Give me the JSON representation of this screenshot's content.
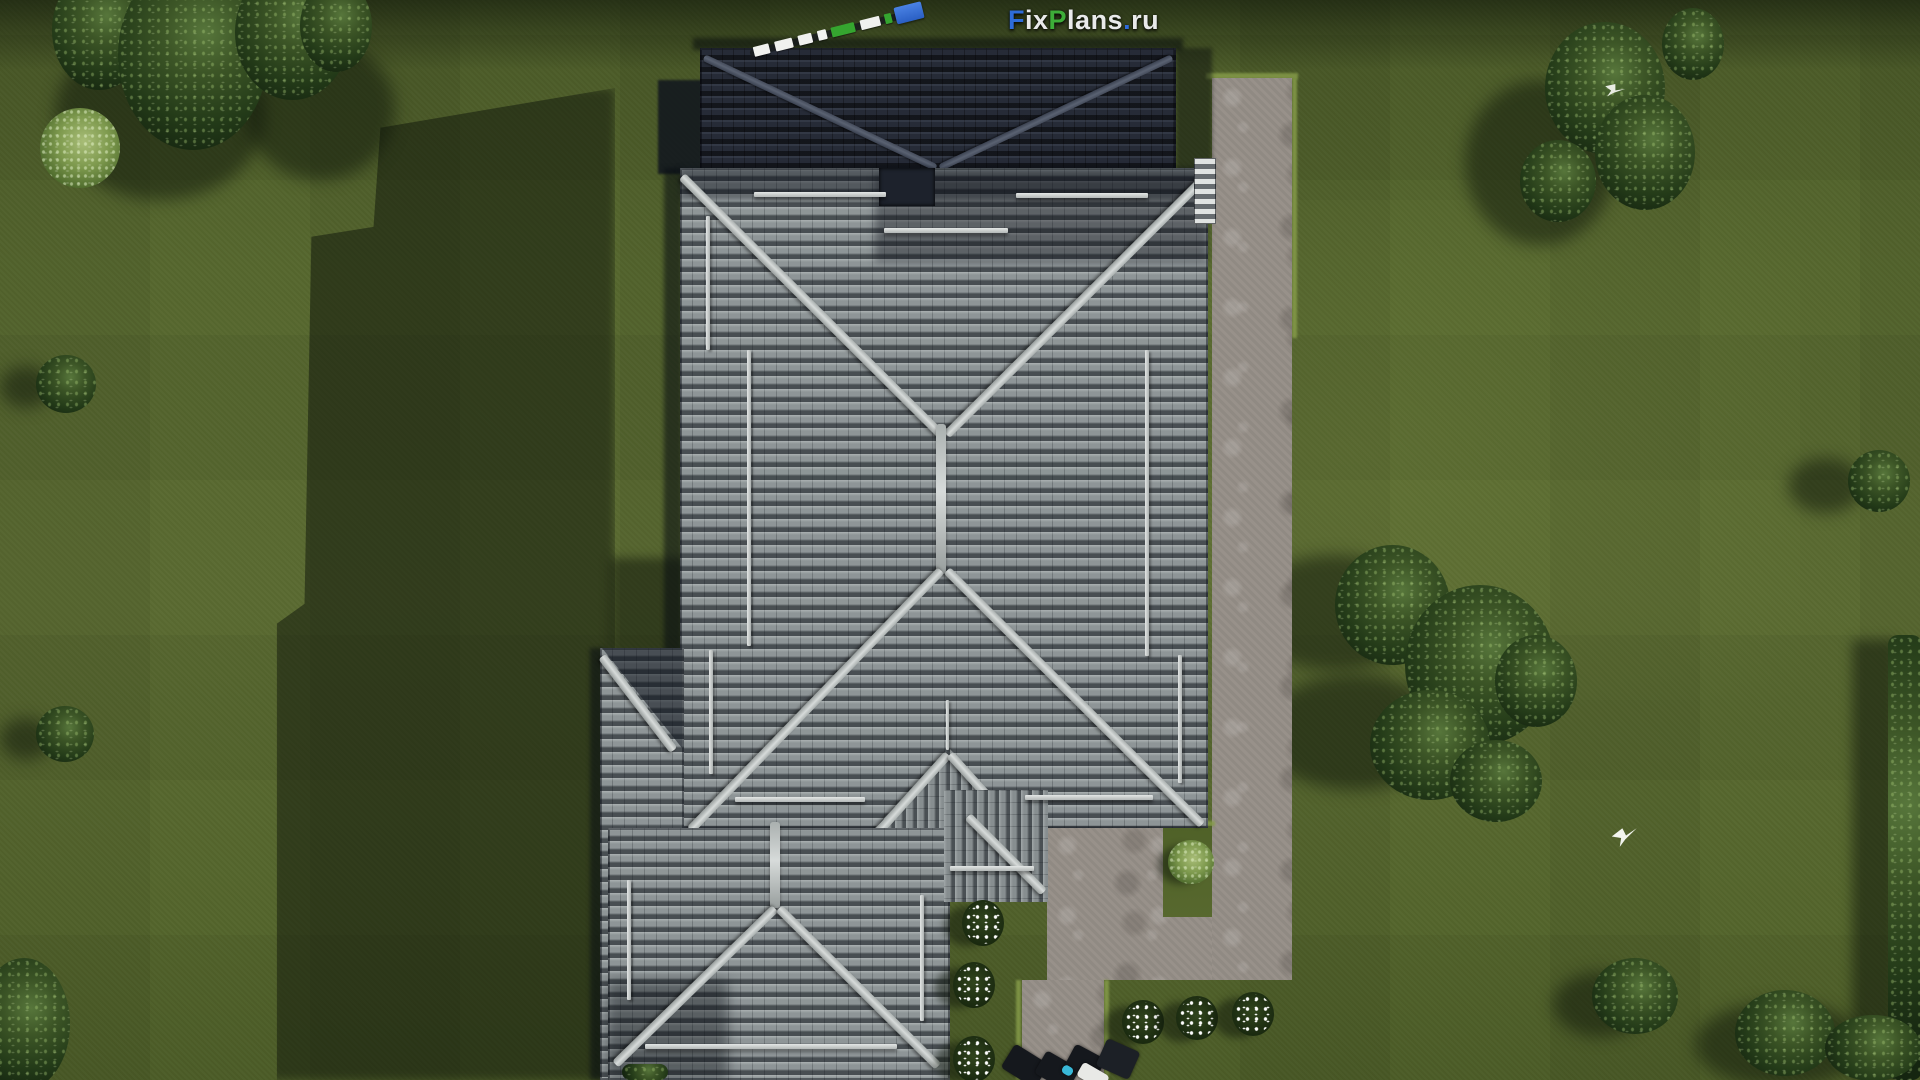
{
  "scene": {
    "description": "Aerial top-down 3D architectural render: single-family house with gray hip tile roofs on a mowed green lawn, L-shaped stone garden path and patio on the right, ornamental trees, white-flowering shrubs, two white birds, surveyor scale rod near the roof",
    "view": "top-down",
    "setting": "daylight, shadows cast toward the left"
  },
  "watermark": {
    "full_text": "FixPlans.ru",
    "segments": [
      {
        "text": "F",
        "color": "#2e6cd9"
      },
      {
        "text": "ix",
        "color": "#e9eaea"
      },
      {
        "text": "P",
        "color": "#3dad39"
      },
      {
        "text": "lans",
        "color": "#e9eaea"
      },
      {
        "text": ".",
        "color": "#2e6cd9"
      },
      {
        "text": "ru",
        "color": "#e9eaea"
      }
    ]
  },
  "palette": {
    "lawn_green": "#55662d",
    "roof_tile_gray": "#8e9597",
    "roof_shadow_dark": "#262b37",
    "ridge_cap": "#ccd1d0",
    "pavement_gray": "#98918a",
    "foliage_dark": "#22371a",
    "flower_white": "#ffffff",
    "rod_green": "#35a52f",
    "rod_blue": "#2f6bd8",
    "bird_white": "#f2f4ee"
  }
}
